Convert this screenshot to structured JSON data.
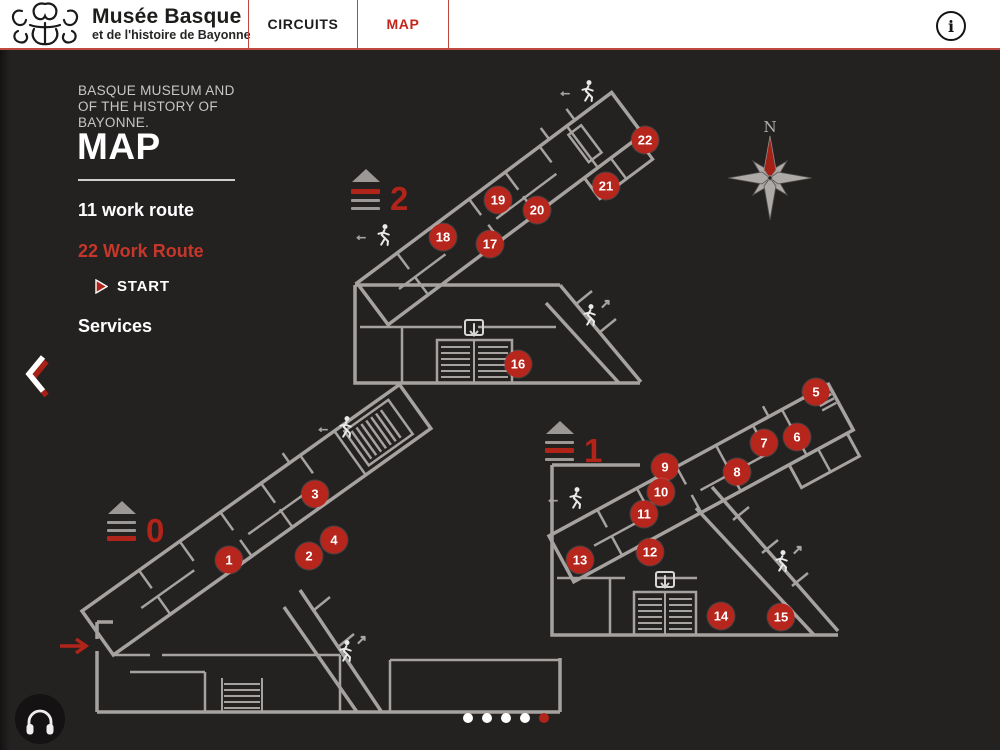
{
  "header": {
    "title": "Musée Basque",
    "subtitle": "et de l'histoire de Bayonne",
    "tabs": [
      {
        "label": "CIRCUITS",
        "active": false
      },
      {
        "label": "MAP",
        "active": true
      }
    ],
    "info_label": "i"
  },
  "sidebar": {
    "heading": "BASQUE MUSEUM AND OF THE HISTORY OF BAYONNE.",
    "title": "MAP",
    "routes": [
      {
        "label": "11 work route",
        "highlight": false
      },
      {
        "label": "22 Work Route",
        "highlight": true
      }
    ],
    "start_label": "START",
    "services_label": "Services"
  },
  "map": {
    "compass_label": "N",
    "floors": [
      {
        "level": "2",
        "red_bar_index": 0,
        "icon": {
          "x": 351,
          "y": 119
        },
        "markers": [
          {
            "n": "16",
            "x": 518,
            "y": 314
          },
          {
            "n": "17",
            "x": 490,
            "y": 194
          },
          {
            "n": "18",
            "x": 443,
            "y": 187
          },
          {
            "n": "19",
            "x": 498,
            "y": 150
          },
          {
            "n": "20",
            "x": 537,
            "y": 160
          },
          {
            "n": "21",
            "x": 606,
            "y": 136
          },
          {
            "n": "22",
            "x": 645,
            "y": 90
          }
        ]
      },
      {
        "level": "1",
        "red_bar_index": 1,
        "icon": {
          "x": 545,
          "y": 371
        },
        "markers": [
          {
            "n": "5",
            "x": 816,
            "y": 342
          },
          {
            "n": "6",
            "x": 797,
            "y": 387
          },
          {
            "n": "7",
            "x": 764,
            "y": 393
          },
          {
            "n": "8",
            "x": 737,
            "y": 422
          },
          {
            "n": "9",
            "x": 665,
            "y": 417
          },
          {
            "n": "10",
            "x": 661,
            "y": 442
          },
          {
            "n": "11",
            "x": 644,
            "y": 464
          },
          {
            "n": "12",
            "x": 650,
            "y": 502
          },
          {
            "n": "13",
            "x": 580,
            "y": 510
          },
          {
            "n": "14",
            "x": 721,
            "y": 566
          },
          {
            "n": "15",
            "x": 781,
            "y": 567
          }
        ]
      },
      {
        "level": "0",
        "red_bar_index": 2,
        "icon": {
          "x": 107,
          "y": 451
        },
        "markers": [
          {
            "n": "1",
            "x": 229,
            "y": 510
          },
          {
            "n": "2",
            "x": 309,
            "y": 506
          },
          {
            "n": "3",
            "x": 315,
            "y": 444
          },
          {
            "n": "4",
            "x": 334,
            "y": 490
          }
        ]
      }
    ]
  },
  "pagination": {
    "count": 5,
    "active_index": 4
  },
  "colors": {
    "accent_red": "#b1241a",
    "marker_red": "#b7261c",
    "wall_gray": "#a5a2a0",
    "bg": "#242121",
    "header_bg": "#ffffff"
  }
}
